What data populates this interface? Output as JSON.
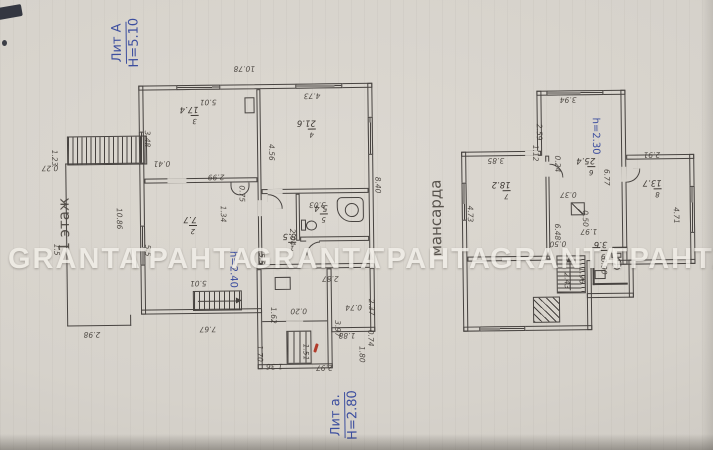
{
  "captions": {
    "building_main": {
      "line1": "Лит А",
      "line2": "Н=5.10"
    },
    "building_annex": {
      "line1": "Лит а.",
      "line2": "Н=2.80"
    },
    "floor_label": "1 этаж",
    "attic_label": "мансарда",
    "height_note_floor": "h=2.40",
    "height_note_attic": "h=2.30"
  },
  "watermark": {
    "words": [
      "GRANTA",
      "ГРАНТА",
      "GRANTA",
      "ГРАНТА",
      "GRANTA",
      "ГРАНТА"
    ]
  },
  "floor1": {
    "rooms": [
      {
        "number": "3",
        "area": "17.4"
      },
      {
        "number": "4",
        "area": "21.6"
      },
      {
        "number": "2",
        "area": "7.7"
      },
      {
        "number": "1",
        "area": "8.5"
      },
      {
        "number": "5",
        "area": "5.4"
      }
    ],
    "dimensions": [
      "10.78",
      "5.01",
      "4.73",
      "3.48",
      "4.56",
      "8.40",
      "0.75",
      "2.99",
      "1.34",
      "3.03",
      "2.04",
      "0.41",
      "10.86",
      "1.23",
      "0.27",
      "1.5",
      "5.5",
      "5.01",
      "5.5",
      "1.62",
      "7.67",
      "2.98",
      "2.87",
      "0.20",
      "3.97",
      "0.74",
      "0.74",
      "2.37",
      "1.88",
      "1.80",
      "1.70",
      "1.51",
      "1.36",
      "2.97"
    ]
  },
  "attic": {
    "rooms": [
      {
        "number": "7",
        "area": "18.2"
      },
      {
        "number": "6",
        "area": "25.4"
      },
      {
        "number": "8",
        "area": "13.7"
      },
      {
        "number": "9",
        "area": "3.6"
      }
    ],
    "dimensions": [
      "3.94",
      "2.59",
      "1.12",
      "0.24",
      "3.85",
      "2.91",
      "4.73",
      "6.77",
      "4.71",
      "6.48",
      "0.37",
      "0.50",
      "1.97",
      "0.50",
      "1.96",
      "2.43",
      "0.90"
    ]
  },
  "colors": {
    "paper": "#d7d3cc",
    "wall": "#474340",
    "pencil": "#3f3a35",
    "ink": "#3c4e9f",
    "wm": "#f2efe9",
    "red": "#b23b2a"
  }
}
